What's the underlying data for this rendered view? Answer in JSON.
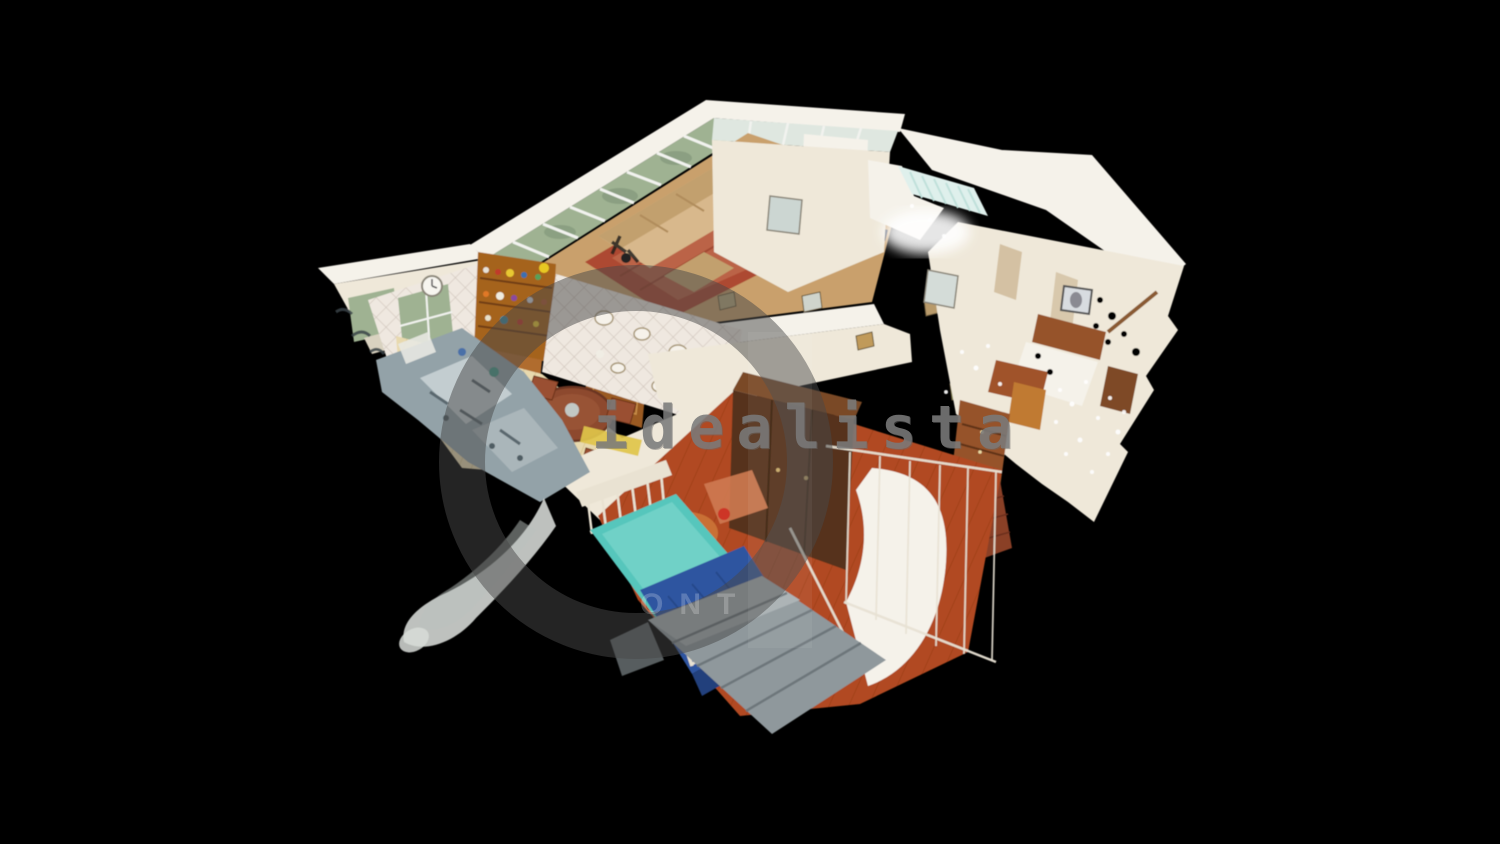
{
  "watermark": {
    "text": "idealista"
  },
  "ghost_watermark": {
    "visible_letters": "ONT"
  },
  "palette": {
    "bg_black": "#000000",
    "watermark_gray": "#7a7a7a",
    "wall": "#f5f2ea",
    "wall_warm": "#efe8d9",
    "wall_shadow": "#d9d2c0",
    "window_green": "#9fb292",
    "window_pale": "#dfe7e0",
    "living_floor": "#c9a06c",
    "rug_red": "#ad4a31",
    "rug_light": "#d08a66",
    "sofa": "#d8b88c",
    "sofa_dark": "#c2a06e",
    "tile": "#efe8e0",
    "tile_line": "#cfc4bb",
    "hutch_wood": "#a5631f",
    "kitchen_wood": "#b06c2e",
    "kitchen_wood_dark": "#9a5a24",
    "plank_floor": "#e8d9ae",
    "plank_line": "#d5c08b",
    "table_wood": "#8d4a2e",
    "red_floor": "#b14a20",
    "red_floor_dark": "#8f3312",
    "wardrobe": "#57331a",
    "wardrobe_light": "#7a4a26",
    "bed_teal": "#57c6bc",
    "bed_teal_light": "#8adbd2",
    "bed_blue": "#2f55a0",
    "bed_blue_dark": "#24407c",
    "bed_frame": "#e9e2d2",
    "orange_cloth": "#c96f35",
    "red_accent": "#cc2a1e",
    "artifact_gray": "#93a2a8",
    "artifact_light": "#c3cdd0",
    "artifact_pale": "#d8dcd8",
    "stair_gray": "#8f989c",
    "furn_brown": "#96522c",
    "furn_orange": "#c07a30",
    "skylight": "#dff0ec",
    "skylight_line": "#bfe0da"
  }
}
